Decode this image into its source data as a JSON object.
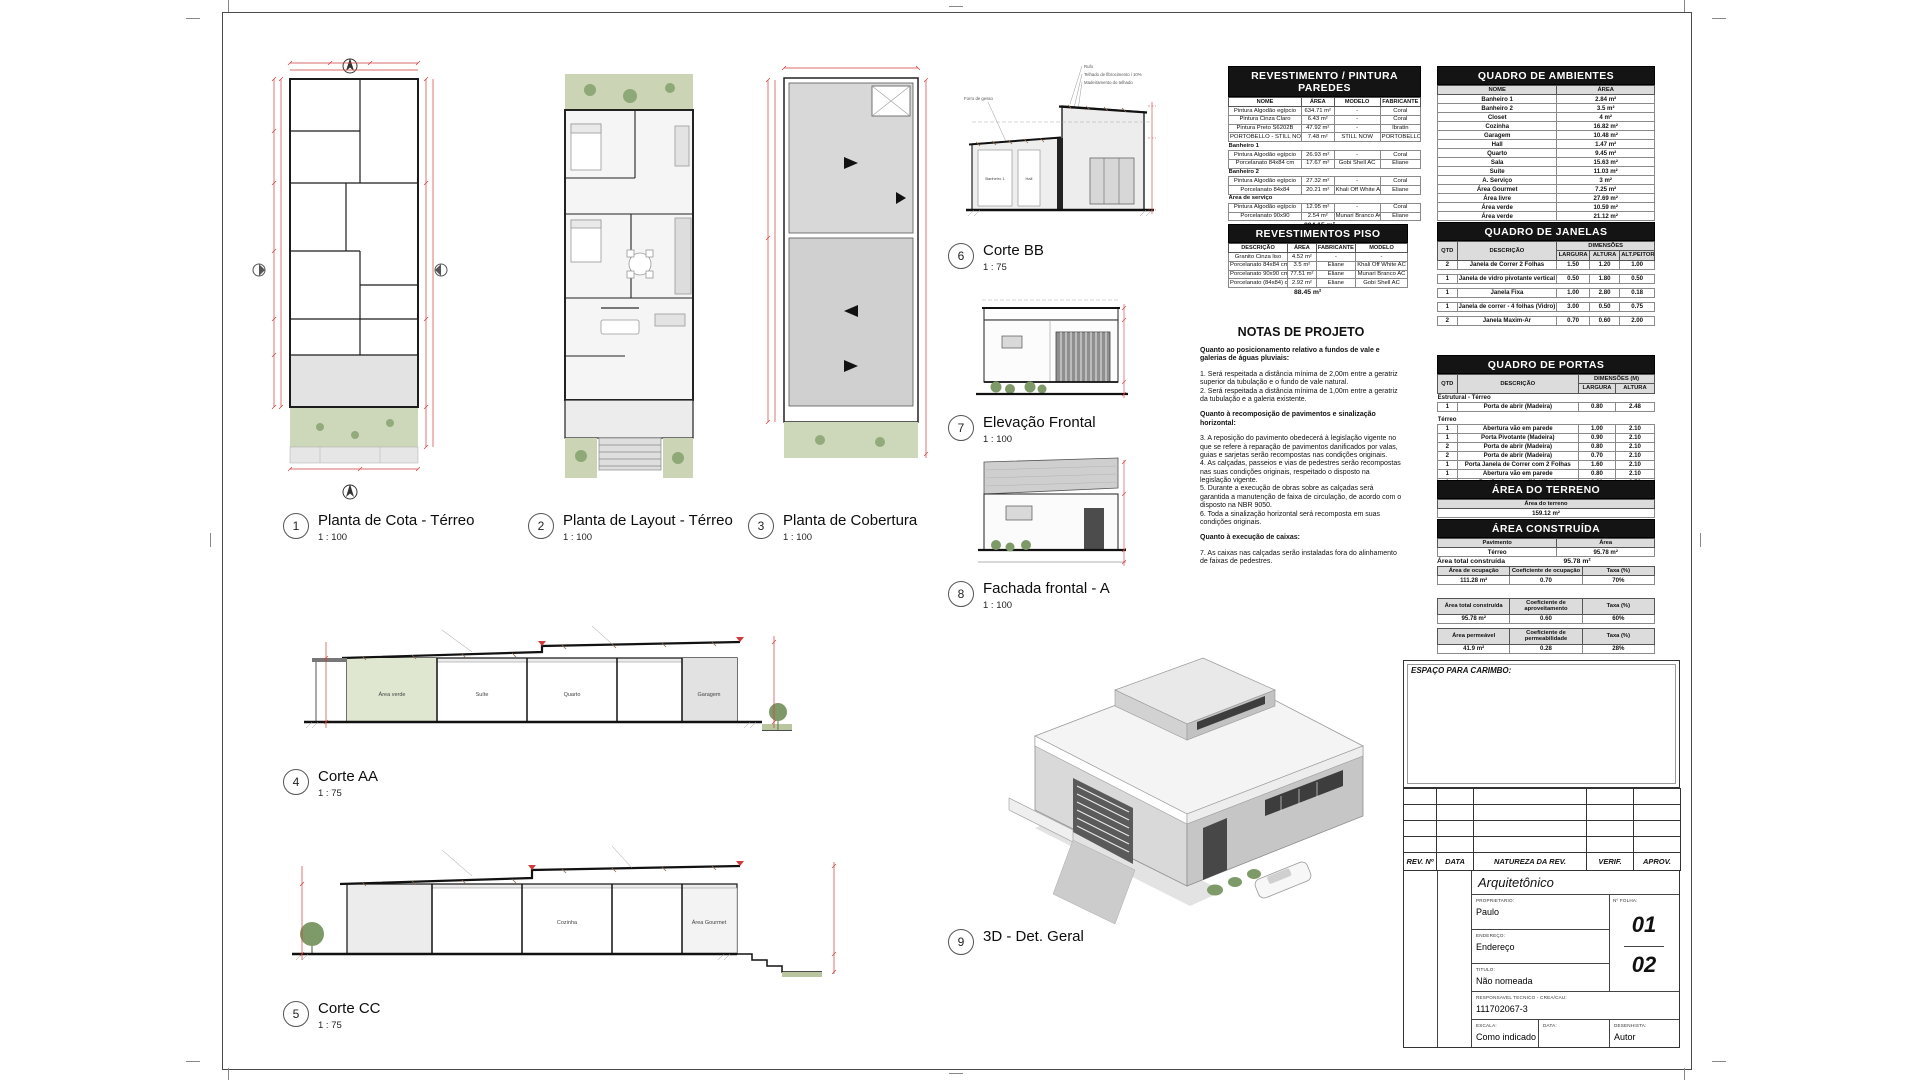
{
  "views": {
    "v1": {
      "num": "1",
      "title": "Planta de Cota - Térreo",
      "scale": "1 : 100"
    },
    "v2": {
      "num": "2",
      "title": "Planta de Layout - Térreo",
      "scale": "1 : 100"
    },
    "v3": {
      "num": "3",
      "title": "Planta de Cobertura",
      "scale": "1 : 100"
    },
    "v4": {
      "num": "4",
      "title": "Corte AA",
      "scale": "1 : 75",
      "rooms": [
        "Área verde",
        "Suíte",
        "Quarto",
        "Garagem"
      ]
    },
    "v5": {
      "num": "5",
      "title": "Corte CC",
      "scale": "1 : 75",
      "rooms": [
        "Cozinha",
        "Área Gourmet"
      ]
    },
    "v6": {
      "num": "6",
      "title": "Corte BB",
      "scale": "1 : 75",
      "annotations": [
        "Rufo",
        "Telhado de fibrocimento i 10%",
        "Madeiramento do telhado",
        "Forro de gesso"
      ],
      "rooms": [
        "Banheiro 1",
        "Hall"
      ]
    },
    "v7": {
      "num": "7",
      "title": "Elevação Frontal",
      "scale": "1 : 100"
    },
    "v8": {
      "num": "8",
      "title": "Fachada frontal - A",
      "scale": "1 : 100"
    },
    "v9": {
      "num": "9",
      "title": "3D - Det. Geral",
      "scale": ""
    }
  },
  "tables": {
    "paredes": {
      "title": "REVESTIMENTO / PINTURA PAREDES",
      "headers": [
        "NOME",
        "ÁREA",
        "MODELO",
        "FABRICANTE"
      ],
      "rows": [
        [
          "Pintura Algodão egípcio",
          "634.71 m²",
          "-",
          "Coral"
        ],
        [
          "Pintura Cinza Claro",
          "6.43 m²",
          "-",
          "Coral"
        ],
        [
          "Pintura Preto S6202B",
          "47.92 m²",
          "-",
          "Ibratin"
        ],
        [
          "PORTOBELLO - STILL NOW SAND 160X160 NAT RET 6MM",
          "7.48 m²",
          "STILL NOW",
          "PORTOBELLO"
        ],
        "Banheiro 1",
        [
          "Pintura Algodão egípcio",
          "26.93 m²",
          "-",
          "Coral"
        ],
        [
          "Porcelanato 84x84 cm",
          "17.67 m²",
          "Gobi Shell AC",
          "Eliane"
        ],
        "Banheiro 2",
        [
          "Pintura Algodão egípcio",
          "27.32 m²",
          "-",
          "Coral"
        ],
        [
          "Porcelanato 84x84",
          "20.21 m²",
          "Khali Off White AC",
          "Eliane"
        ],
        "Área de serviço",
        [
          "Pintura Algodão egípcio",
          "12.95 m²",
          "-",
          "Coral"
        ],
        [
          "Porcelanato 90x90",
          "2.54 m²",
          "Munari Branco AC",
          "Eliane"
        ]
      ],
      "total": "804.15 m²"
    },
    "piso": {
      "title": "REVESTIMENTOS PISO",
      "headers": [
        "DESCRIÇÃO",
        "ÁREA",
        "FABRICANTE",
        "MODELO"
      ],
      "rows": [
        [
          "Granito Cinza liso",
          "4.52 m²",
          "-",
          "-"
        ],
        [
          "Porcelanato 84x84 cm",
          "3.5 m²",
          "Eliane",
          "Khali Off White AC"
        ],
        [
          "Porcelanato 90x90 cm",
          "77.51 m²",
          "Eliane",
          "Munari Branco AC"
        ],
        [
          "Porcelanato (84x84) cm",
          "2.92 m²",
          "Eliane",
          "Gobi Shell AC"
        ]
      ],
      "total": "88.45 m²"
    },
    "ambientes": {
      "title": "QUADRO DE AMBIENTES",
      "headers": [
        "NOME",
        "ÁREA"
      ],
      "rows": [
        [
          "Banheiro 1",
          "2.84 m²"
        ],
        [
          "Banheiro 2",
          "3.5 m²"
        ],
        [
          "Closet",
          "4 m²"
        ],
        [
          "Cozinha",
          "16.82 m²"
        ],
        [
          "Garagem",
          "10.48 m²"
        ],
        [
          "Hall",
          "1.47 m²"
        ],
        [
          "Quarto",
          "9.45 m²"
        ],
        [
          "Sala",
          "15.63 m²"
        ],
        [
          "Suíte",
          "11.03 m²"
        ],
        [
          "A. Serviço",
          "3 m²"
        ],
        [
          "Área Gourmet",
          "7.25 m²"
        ],
        [
          "Área livre",
          "27.69 m²"
        ],
        [
          "Área verde",
          "10.59 m²"
        ],
        [
          "Área verde",
          "21.12 m²"
        ]
      ],
      "foot": [
        [
          "Térreo",
          "142.97 m²"
        ],
        [
          "Total Geral",
          "142.97 m²"
        ]
      ]
    },
    "janelas": {
      "title": "QUADRO DE JANELAS",
      "h_qtd": "QTD",
      "h_desc": "DESCRIÇÃO",
      "h_dim": "DIMENSÕES",
      "h_cols": [
        "LARGURA",
        "ALTURA",
        "ALT.PEITORIL"
      ],
      "rows": [
        [
          "2",
          "Janela de Correr 2 Folhas",
          "1.50",
          "1.20",
          "1.00"
        ],
        "",
        [
          "1",
          "Janela de vidro pivotante vertical",
          "0.50",
          "1.80",
          "0.50"
        ],
        "",
        [
          "1",
          "Janela Fixa",
          "1.00",
          "2.80",
          "0.18"
        ],
        "",
        [
          "1",
          "Janela de correr - 4 folhas (Vidro)",
          "3.00",
          "0.50",
          "0.75"
        ],
        "",
        [
          "2",
          "Janela Maxim-Ar",
          "0.70",
          "0.60",
          "2.00"
        ]
      ]
    },
    "portas": {
      "title": "QUADRO DE PORTAS",
      "h_qtd": "QTD",
      "h_desc": "DESCRIÇÃO",
      "h_dim": "DIMENSÕES (M)",
      "h_cols": [
        "LARGURA",
        "ALTURA"
      ],
      "rows": [
        "Estrutural - Térreo",
        [
          "1",
          "Porta de abrir (Madeira)",
          "0.80",
          "2.48"
        ],
        "",
        "Térreo",
        [
          "1",
          "Abertura vão em parede",
          "1.00",
          "2.10"
        ],
        [
          "1",
          "Porta Pivotante (Madeira)",
          "0.90",
          "2.10"
        ],
        [
          "2",
          "Porta de abrir (Madeira)",
          "0.80",
          "2.10"
        ],
        [
          "2",
          "Porta de abrir (Madeira)",
          "0.70",
          "2.10"
        ],
        [
          "1",
          "Porta Janela de Correr com 2 Folhas",
          "1.60",
          "2.10"
        ],
        [
          "1",
          "Abertura vão em parede",
          "0.80",
          "2.10"
        ],
        [
          "1",
          "Portão de correr (Metálico)",
          "3.20",
          "2.50"
        ]
      ]
    },
    "terreno": {
      "title": "ÁREA DO TERRENO",
      "header": "Área do terreno",
      "value": "159.12 m²"
    },
    "construida": {
      "title": "ÁREA CONSTRUÍDA",
      "headers": [
        "Pavimento",
        "Área"
      ],
      "rows": [
        [
          "Térreo",
          "95.78 m²"
        ]
      ],
      "foot": [
        "Área total construída",
        "95.78 m²"
      ]
    },
    "ratios": [
      {
        "headers": [
          "Área de ocupação",
          "Coeficiente de ocupação",
          "Taxa (%)"
        ],
        "values": [
          "111.28 m²",
          "0.70",
          "70%"
        ]
      },
      {
        "headers": [
          "Área total construída",
          "Coeficiente de aproveitamento",
          "Taxa (%)"
        ],
        "values": [
          "95.78 m²",
          "0.60",
          "60%"
        ]
      },
      {
        "headers": [
          "Área permeável",
          "Coeficiente de permeabilidade",
          "Taxa (%)"
        ],
        "values": [
          "41.9 m²",
          "0.28",
          "28%"
        ]
      }
    ]
  },
  "notes": {
    "title": "NOTAS DE PROJETO",
    "blocks": [
      {
        "bold": true,
        "text": "Quanto ao posicionamento relativo a fundos de vale e galerias de águas pluviais:"
      },
      {
        "bold": false,
        "text": "1. Será respeitada a distância mínima de 2,00m entre a geratriz superior da tubulação e o fundo de vale natural.\n2. Será respeitada a distância mínima de 1,00m entre a geratriz da tubulação e a galeria existente."
      },
      {
        "bold": true,
        "text": "Quanto à recomposição de pavimentos e sinalização horizontal:"
      },
      {
        "bold": false,
        "text": "3. A reposição do pavimento obedecerá à legislação vigente no que se refere à reparação de pavimentos danificados por valas, guias e sarjetas serão recompostas nas condições originais.\n4. As calçadas, passeios e vias de pedestres serão recompostas nas suas condições originais, respeitado o disposto na legislação vigente.\n5. Durante a execução de obras sobre as calçadas será garantida a manutenção de faixa de circulação, de acordo com o disposto na NBR 9050.\n6. Toda a sinalização horizontal será recomposta em suas condições originais."
      },
      {
        "bold": true,
        "text": "Quanto à execução de caixas:"
      },
      {
        "bold": false,
        "text": "7. As caixas nas calçadas serão instaladas fora do alinhamento de faixas de pedestres."
      }
    ]
  },
  "titleblock": {
    "carimbo": "ESPAÇO PARA CARIMBO:",
    "rev_headers": [
      "REV. Nº",
      "DATA",
      "NATUREZA DA REV.",
      "VERIF.",
      "APROV."
    ],
    "discipline": "Arquitetônico",
    "proprietario_label": "PROPRIETARIO:",
    "proprietario": "Paulo",
    "endereco_label": "ENDEREÇO:",
    "endereco": "Endereço",
    "titulo_label": "TITULO:",
    "titulo": "Não nomeada",
    "folha_label": "Nº FOLHA:",
    "folha_num": "01",
    "folha_total": "02",
    "resp_label": "RESPONSAVEL TECNICO - CREA/CAU:",
    "resp": "111702067-3",
    "escala_label": "ESCALA:",
    "escala": "Como indicado",
    "data_label": "DATA:",
    "data": "",
    "desenhista_label": "DESENHISTA:",
    "desenhista": "Autor"
  }
}
